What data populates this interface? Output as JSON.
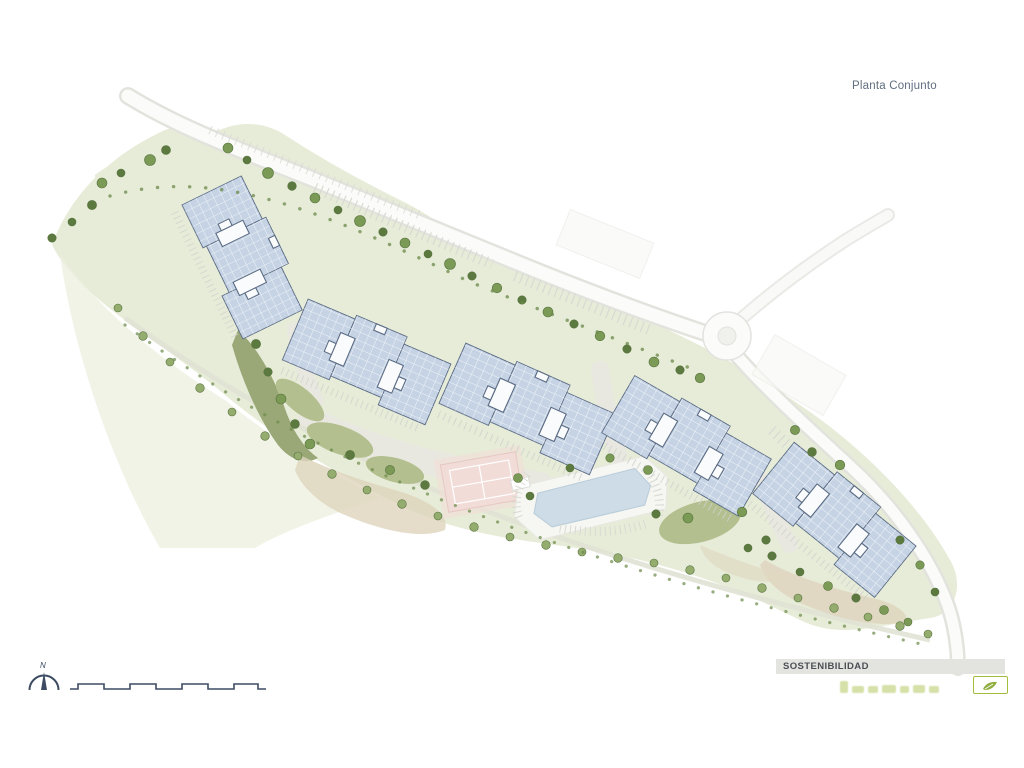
{
  "title": "Planta Conjunto",
  "north": {
    "label": "N"
  },
  "sustainability": {
    "header": "SOSTENIBILIDAD"
  },
  "plan": {
    "name": "residential-site-plan",
    "building_blocks": 5,
    "amenities": [
      "pool",
      "tennis-court",
      "gardens",
      "tree-lined-path",
      "roundabout",
      "parking-bays"
    ]
  },
  "palette": {
    "landscape_green": "#e7ecd8",
    "lawn_light": "#edf0e1",
    "hedge_olive": "#b3bf8e",
    "hedge_dark": "#9aa878",
    "tree_dark": "#5c7a40",
    "tree_mid": "#7b9a55",
    "tree_light": "#94ac6e",
    "building_fill": "#c5d3e4",
    "building_outline": "#5a6b84",
    "building_core": "#fafbfc",
    "road_edge": "#e3e3de",
    "road_fill": "#fbfbf9",
    "path_gray": "#e9e8e2",
    "pool_blue": "#cddce7",
    "pool_deck": "#f6f6f3",
    "court_pink": "#f2dcd7",
    "sand": "#dfd4bd",
    "ink_navy": "#3d4c63",
    "title_color": "#5f6e80",
    "sustain_bar_bg": "#e3e3e0",
    "sustain_text": "#4a4f54",
    "eco_green": "#a3bd3f"
  }
}
